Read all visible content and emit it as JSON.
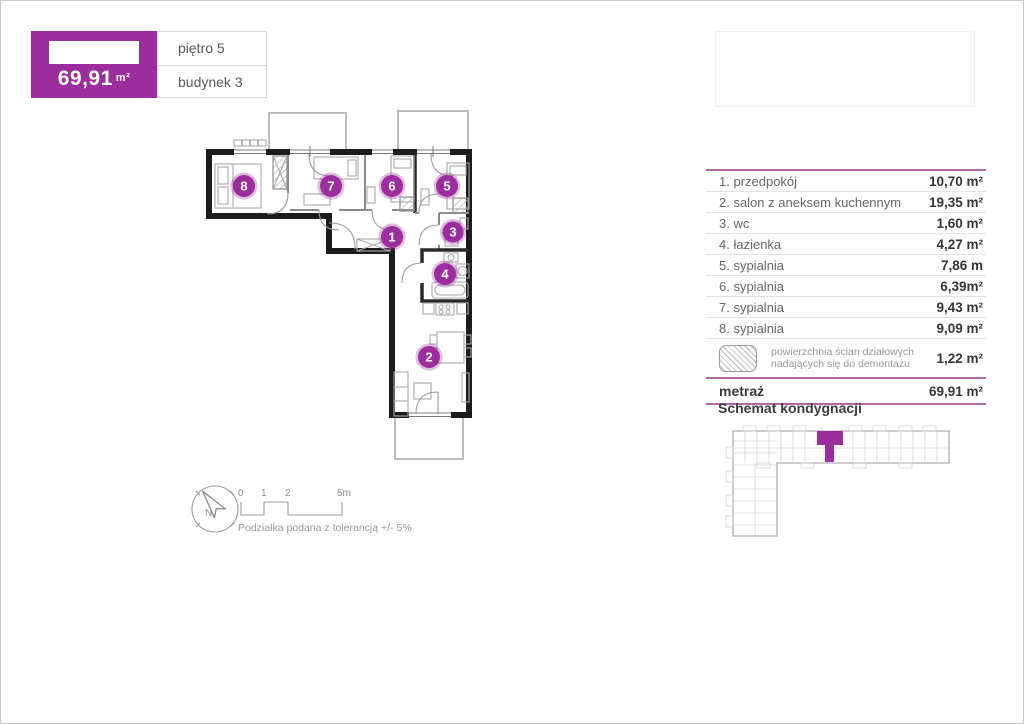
{
  "colors": {
    "accent": "#9b2d9c",
    "table_line": "#b06aab",
    "wall": "#1c1c1c"
  },
  "header": {
    "area": "69,91",
    "unit": "m²",
    "floor": "piętro 5",
    "building": "budynek 3"
  },
  "table": {
    "rows": [
      {
        "label": "1. przedpokój",
        "value": "10,70 m²"
      },
      {
        "label": "2. salon z aneksem kuchennym",
        "value": "19,35 m²"
      },
      {
        "label": "3. wc",
        "value": "1,60 m²"
      },
      {
        "label": "4. łazienka",
        "value": "4,27 m²"
      },
      {
        "label": "5. sypialnia",
        "value": "7,86 m"
      },
      {
        "label": "6. sypialnia",
        "value": "6,39m²"
      },
      {
        "label": "7. sypialnia",
        "value": "9,43 m²"
      },
      {
        "label": "8. sypialnia",
        "value": "9,09 m²"
      }
    ],
    "legend": {
      "line1": "powierzchnia ścian działowych",
      "line2": "nadających się do demontażu",
      "value": "1,22 m²"
    },
    "total": {
      "label": "metraż",
      "value": "69,91 m²"
    }
  },
  "schematic": {
    "title": "Schemat kondygnacji"
  },
  "floorplan": {
    "numbers": [
      "1",
      "2",
      "3",
      "4",
      "5",
      "6",
      "7",
      "8"
    ]
  },
  "compass": {
    "north": "N"
  },
  "scalebar": {
    "ticks": [
      "0",
      "1",
      "2",
      "5m"
    ],
    "note": "Podziałka podana z tolerancją +/- 5%"
  }
}
